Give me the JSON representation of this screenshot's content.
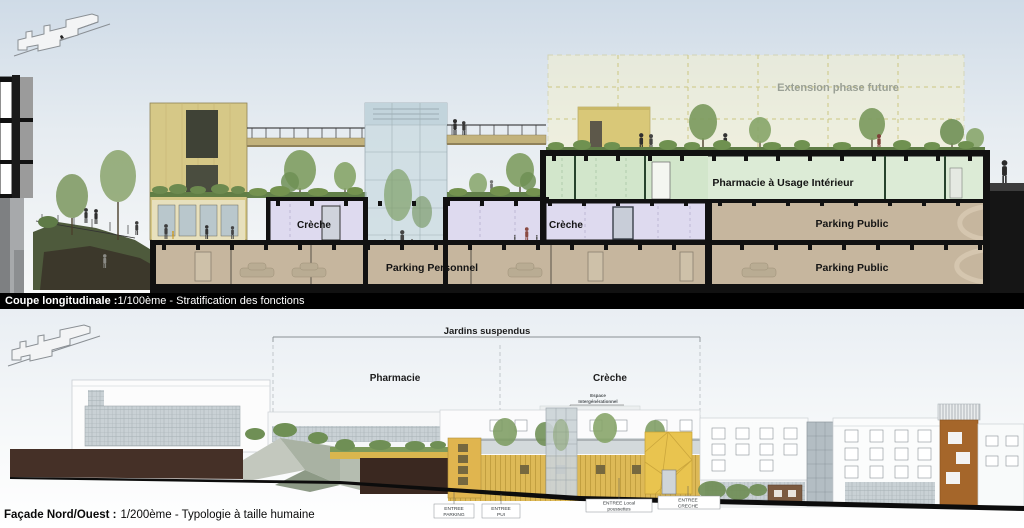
{
  "top": {
    "title_name": "Coupe longitudinale :",
    "title_rest": "1/100ème  - Stratification des fonctions",
    "extension_label": "Extension phase future",
    "pharmacie_ui_label": "Pharmacie à Usage Intérieur",
    "creche_left_label": "Crèche",
    "creche_right_label": "Crèche",
    "parking_personnel_label": "Parking Personnel",
    "parking_public_upper_label": "Parking Public",
    "parking_public_lower_label": "Parking Public"
  },
  "bottom": {
    "jardins_label": "Jardins suspendus",
    "pharmacie_label": "Pharmacie",
    "creche_label": "Crèche",
    "espace_line1": "Espace",
    "espace_line2": "Intergénérationnel",
    "entrances": [
      {
        "l1": "ENTREE",
        "l2": "PARKING"
      },
      {
        "l1": "ENTREE",
        "l2": "PUI"
      },
      {
        "l1": "ENTREE Local",
        "l2": "poussettes"
      },
      {
        "l1": "ENTREE",
        "l2": "CRECHE"
      }
    ],
    "title_name": "Façade Nord/Ouest :",
    "title_rest": "1/200ème  - Typologie à taille humaine"
  },
  "colors": {
    "creche_fill": "#dedaef",
    "pharmacie_fill": "#dcebd6",
    "parking_fill": "#c6b69e",
    "extension_fill": "#f5f1cd",
    "facade_wood_yellow": "#ddb957",
    "tower_yellow": "#d6c887",
    "orange_tower": "#a5662a",
    "section_cut_black": "#111111"
  }
}
